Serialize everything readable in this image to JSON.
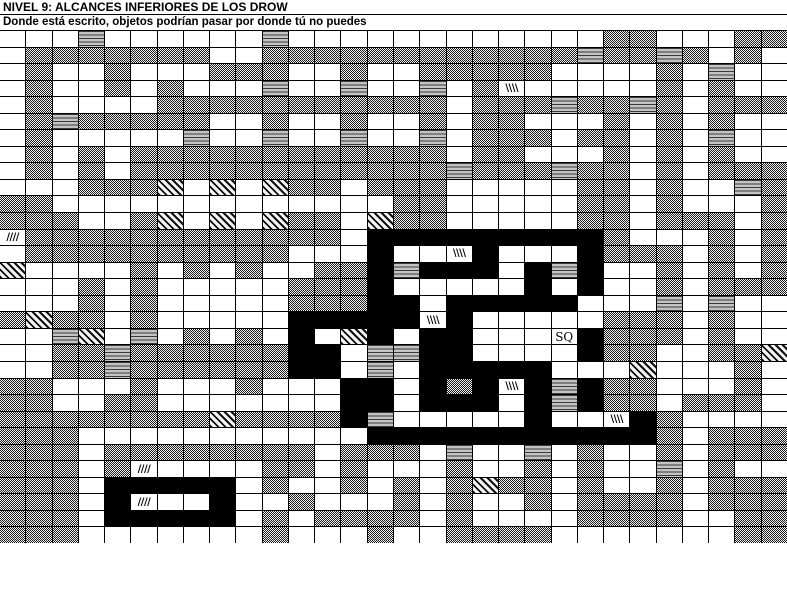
{
  "header": {
    "title": "NIVEL 9: ALCANCES INFERIORES DE LOS DROW",
    "subtitle": "Donde está escrito, objetos podrían pasar por donde tú no puedes"
  },
  "colors": {
    "floor": "#ffffff",
    "wall_black": "#000000",
    "rock_dither_dark": "#1e1e1e",
    "rock_dither_light": "#efefef",
    "door_background": "#c3c3c3",
    "door_stripe": "#3a3a3a",
    "gridline": "#000000"
  },
  "legend": {
    "W": "open-floor",
    "G": "solid-rock-dither",
    "B": "black-wall",
    "H": "horizontal-stripe-door",
    "D": "diagonal-hatch",
    "1": "slash-marker-cell",
    "2": "backslash-marker-cell",
    "S": "sq-marker-cell"
  },
  "cell_glyphs": {
    "1": "////",
    "2": "\\\\\\\\",
    "S": "SQ"
  },
  "map": {
    "columns": 30,
    "rows_count": 31,
    "rows": [
      "WWWHWWWWWWHWWWWWWWWWWWWGGWWWGGG",
      "WGGGGGGGWWGGGGGGGGGGGGHGGHGWGWW",
      "WGWWGWWWGGGWWGWWGGGGGWWWWGWHWW",
      "WGWWGWGWWWHWWHWWHWG2WWWWWGWGWW",
      "WGWWWWGGGGGGGGGGGWGGGHGGHGWGGG",
      "WGHGGGGGWWGWWGWWGWGGWWWGWGWGWW",
      "WGWWWWWHWWHWWHWWHWGGGWGGWGWHWW",
      "WGWGWGGGGGGGGGGGGWGGWWWGWGWGWW",
      "WGWGWGGGGGGGGGGGGHGGGHGGWGWGGG",
      "WWWGGGDWDWDGGWGGGWWWWWGGWGWWHG",
      "GGWWWWWWWWWWWWWGGWWWWWGGWGWWWG",
      "GGGWWGDWDWDGGWDGGWWWWWGGWGGGWG",
      "1GGGGGGGGGGGGWBBBBBBBBBGWWWGWG",
      "WGGGGGGGGGGWWWBWW2BWWWBGGGWGWG",
      "DWWWWGWGWGWWGGBHBBBWBHBWWGWGWG",
      "WWWGWGWWWWWGGGBWWWWWBWBWWGWGGG",
      "WWWGWGWWWWWGGGBBWBBBBBWWWHWHWW",
      "GDGGWGWWWWWBBBBB2BWWWWWGGGWGWW",
      "WWHDWHWGWGWBWDBWBBWWWSBGGGWGWW",
      "WWGGHGGGGGGBBWHHBBWWWWBGGWWGGD",
      "WWGGHGGGGGGBBWHWBBBBBWWWDWWWGW",
      "GGWWWGWWWGWWWBBWBGB2BHBGGWWWGW",
      "GGWWGGWWWWWWWBBWBBBWBHBGGWGGGW",
      "GGGGGGGGDGGGGBHWWWWWBWW2BGWWWW",
      "GGGWWWWWWWWWWWBBBBBBBBBBBGWGGG",
      "GGGWGGGGGGGGWGGGWHWWHWGWWGWGGG",
      "GGGWG1WWWWGGWGWWWGWWGWGWWHWGWW",
      "GGGWBBBBBWGWWGWGWGDGGWGWWGWGGG",
      "GGGWB1WWBWWGWWWGWGWWGWGGGGWGGG",
      "GGGWBBBBBWGWGGGGWGWWWWGGGGWWGG",
      "GGGWWWWWWWGWWWGWWGGGGWWWWWWWGG"
    ]
  }
}
